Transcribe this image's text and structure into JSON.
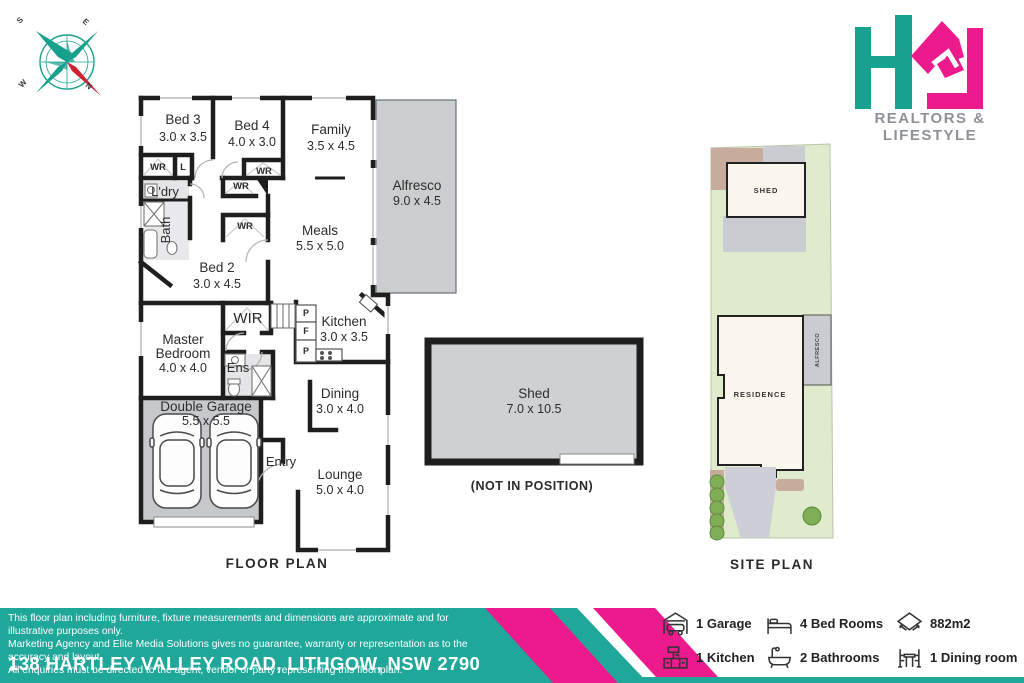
{
  "brand": {
    "tagline": "REALTORS & LIFESTYLE",
    "colors": {
      "teal": "#16A28F",
      "pink": "#EC1A8D"
    }
  },
  "compass": {
    "points": {
      "n": "N",
      "s": "S",
      "e": "E",
      "w": "W"
    }
  },
  "floorplan": {
    "title": "FLOOR PLAN",
    "shed_note": "(NOT IN POSITION)",
    "rooms": {
      "bed3": {
        "name": "Bed 3",
        "dims": "3.0 x 3.5"
      },
      "bed4": {
        "name": "Bed 4",
        "dims": "4.0 x 3.0"
      },
      "family": {
        "name": "Family",
        "dims": "3.5 x 4.5"
      },
      "alfresco": {
        "name": "Alfresco",
        "dims": "9.0 x 4.5"
      },
      "meals": {
        "name": "Meals",
        "dims": "5.5 x 5.0"
      },
      "bed2": {
        "name": "Bed 2",
        "dims": "3.0 x 4.5"
      },
      "kitchen": {
        "name": "Kitchen",
        "dims": "3.0 x 3.5"
      },
      "master": {
        "line1": "Master",
        "line2": "Bedroom",
        "dims": "4.0 x 4.0"
      },
      "dining": {
        "name": "Dining",
        "dims": "3.0 x 4.0"
      },
      "garage": {
        "name": "Double Garage",
        "dims": "5.5 x 5.5"
      },
      "lounge": {
        "name": "Lounge",
        "dims": "5.0 x 4.0"
      },
      "shed": {
        "name": "Shed",
        "dims": "7.0 x 10.5"
      }
    },
    "small_labels": {
      "wir": "WIR",
      "ens": "Ens",
      "laundry": "L'dry",
      "bath": "Bath",
      "entry": "Entry",
      "wardrobe": "WR",
      "linen": "L",
      "pantry": "P",
      "fridge": "F"
    }
  },
  "siteplan": {
    "title": "SITE PLAN",
    "labels": {
      "shed": "SHED",
      "residence": "RESIDENCE",
      "alfresco": "ALFRESCO"
    }
  },
  "footer": {
    "disclaimer_lines": [
      "This floor plan including furniture, fixture measurements and dimensions are approximate and for illustrative purposes only.",
      "Marketing Agency and Elite Media Solutions gives no guarantee, warranty or representation as to the accuracy and layout.",
      "All enquiries must be directed to the agent, vendor or party representing this floor plan."
    ],
    "address": "138 HARTLEY VALLEY ROAD, LITHGOW, NSW 2790"
  },
  "summary": {
    "items": [
      {
        "name": "garage",
        "label": "1 Garage"
      },
      {
        "name": "bedrooms",
        "label": "4 Bed Rooms"
      },
      {
        "name": "area",
        "label": "882m2"
      },
      {
        "name": "kitchen",
        "label": "1 Kitchen"
      },
      {
        "name": "bathrooms",
        "label": "2 Bathrooms"
      },
      {
        "name": "dining",
        "label": "1 Dining room"
      }
    ]
  }
}
